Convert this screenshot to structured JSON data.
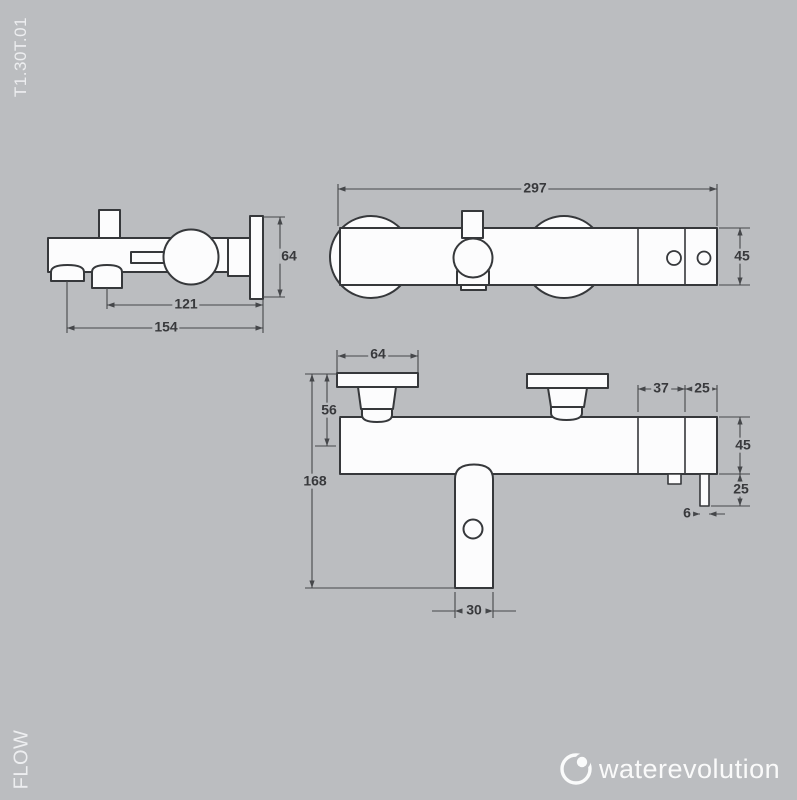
{
  "page": {
    "code": "T1.30T.01",
    "flow_label": "FLOW"
  },
  "colors": {
    "background": "#bbbdc0",
    "object_line": "#36383b",
    "dimension_line": "#45474a",
    "dimension_text": "#38393c",
    "side_text": "#edeef0",
    "logo": "#ffffff",
    "shape_fill": "#fcfcfd"
  },
  "logo": {
    "text": "waterevolution"
  },
  "views": {
    "side": {
      "name": "side-view",
      "dims": {
        "plate_height": "64",
        "shower_outlet_to_wall": "121",
        "spout_to_wall": "154"
      }
    },
    "top": {
      "name": "top-view",
      "dims": {
        "overall_width": "297",
        "body_depth": "45"
      }
    },
    "front": {
      "name": "front-view",
      "dims": {
        "handle_plate_width": "64",
        "handle_top_to_axis": "56",
        "overall_height": "168",
        "spout_width": "30",
        "right_section_a": "37",
        "right_section_b": "25",
        "body_height": "45",
        "outlet_drop": "25",
        "outlet_pipe_width": "6"
      }
    }
  }
}
